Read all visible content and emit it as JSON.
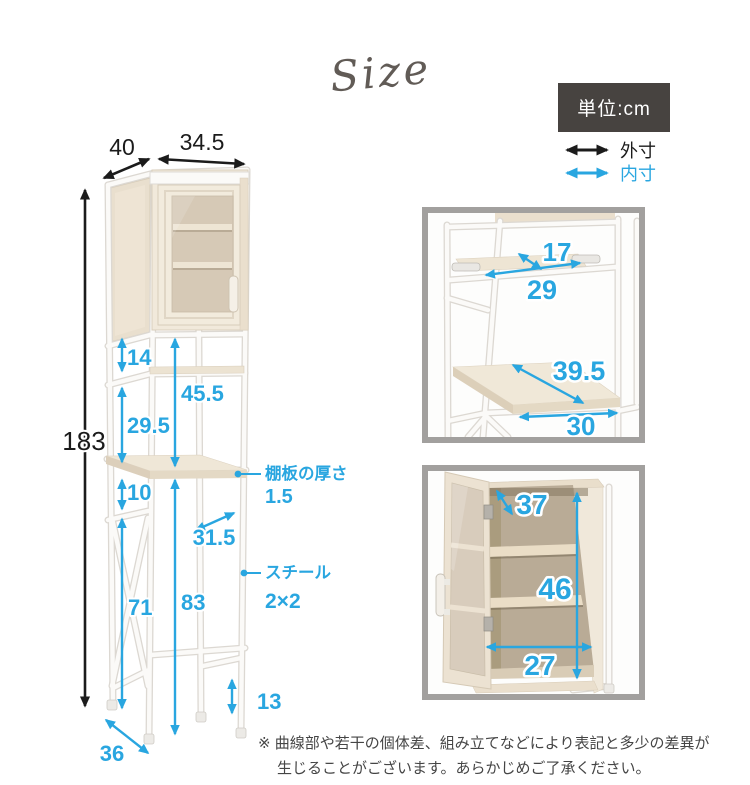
{
  "header": {
    "script_title": "Size",
    "unit_label": "単位:cm"
  },
  "legend": {
    "outer": "外寸",
    "inner": "内寸"
  },
  "main": {
    "depth": "40",
    "width": "34.5",
    "height": "183",
    "gap_top": "14",
    "inner_height": "45.5",
    "gap_mid": "29.5",
    "gap_below_shelf": "10",
    "inner_width": "31.5",
    "leg_height": "71",
    "clearance_height": "83",
    "foot_height": "13",
    "depth_bottom": "36",
    "shelf_label": "棚板の厚さ",
    "shelf_value": "1.5",
    "steel_label": "スチール",
    "steel_value": "2×2"
  },
  "shelf_panel": {
    "depth": "17",
    "width": "29",
    "diagonal": "39.5",
    "width_bottom": "30"
  },
  "cabinet_panel": {
    "depth": "37",
    "height": "46",
    "width": "27"
  },
  "note": {
    "line1": "※ 曲線部や若干の個体差、組み立てなどにより表記と多少の差異が",
    "line2": "生じることがございます。あらかじめご了承ください。"
  },
  "colors": {
    "accent": "#29a6e0",
    "ink": "#1b1b1b",
    "unit_bg": "#474340",
    "panel_border": "#a2a09e"
  }
}
